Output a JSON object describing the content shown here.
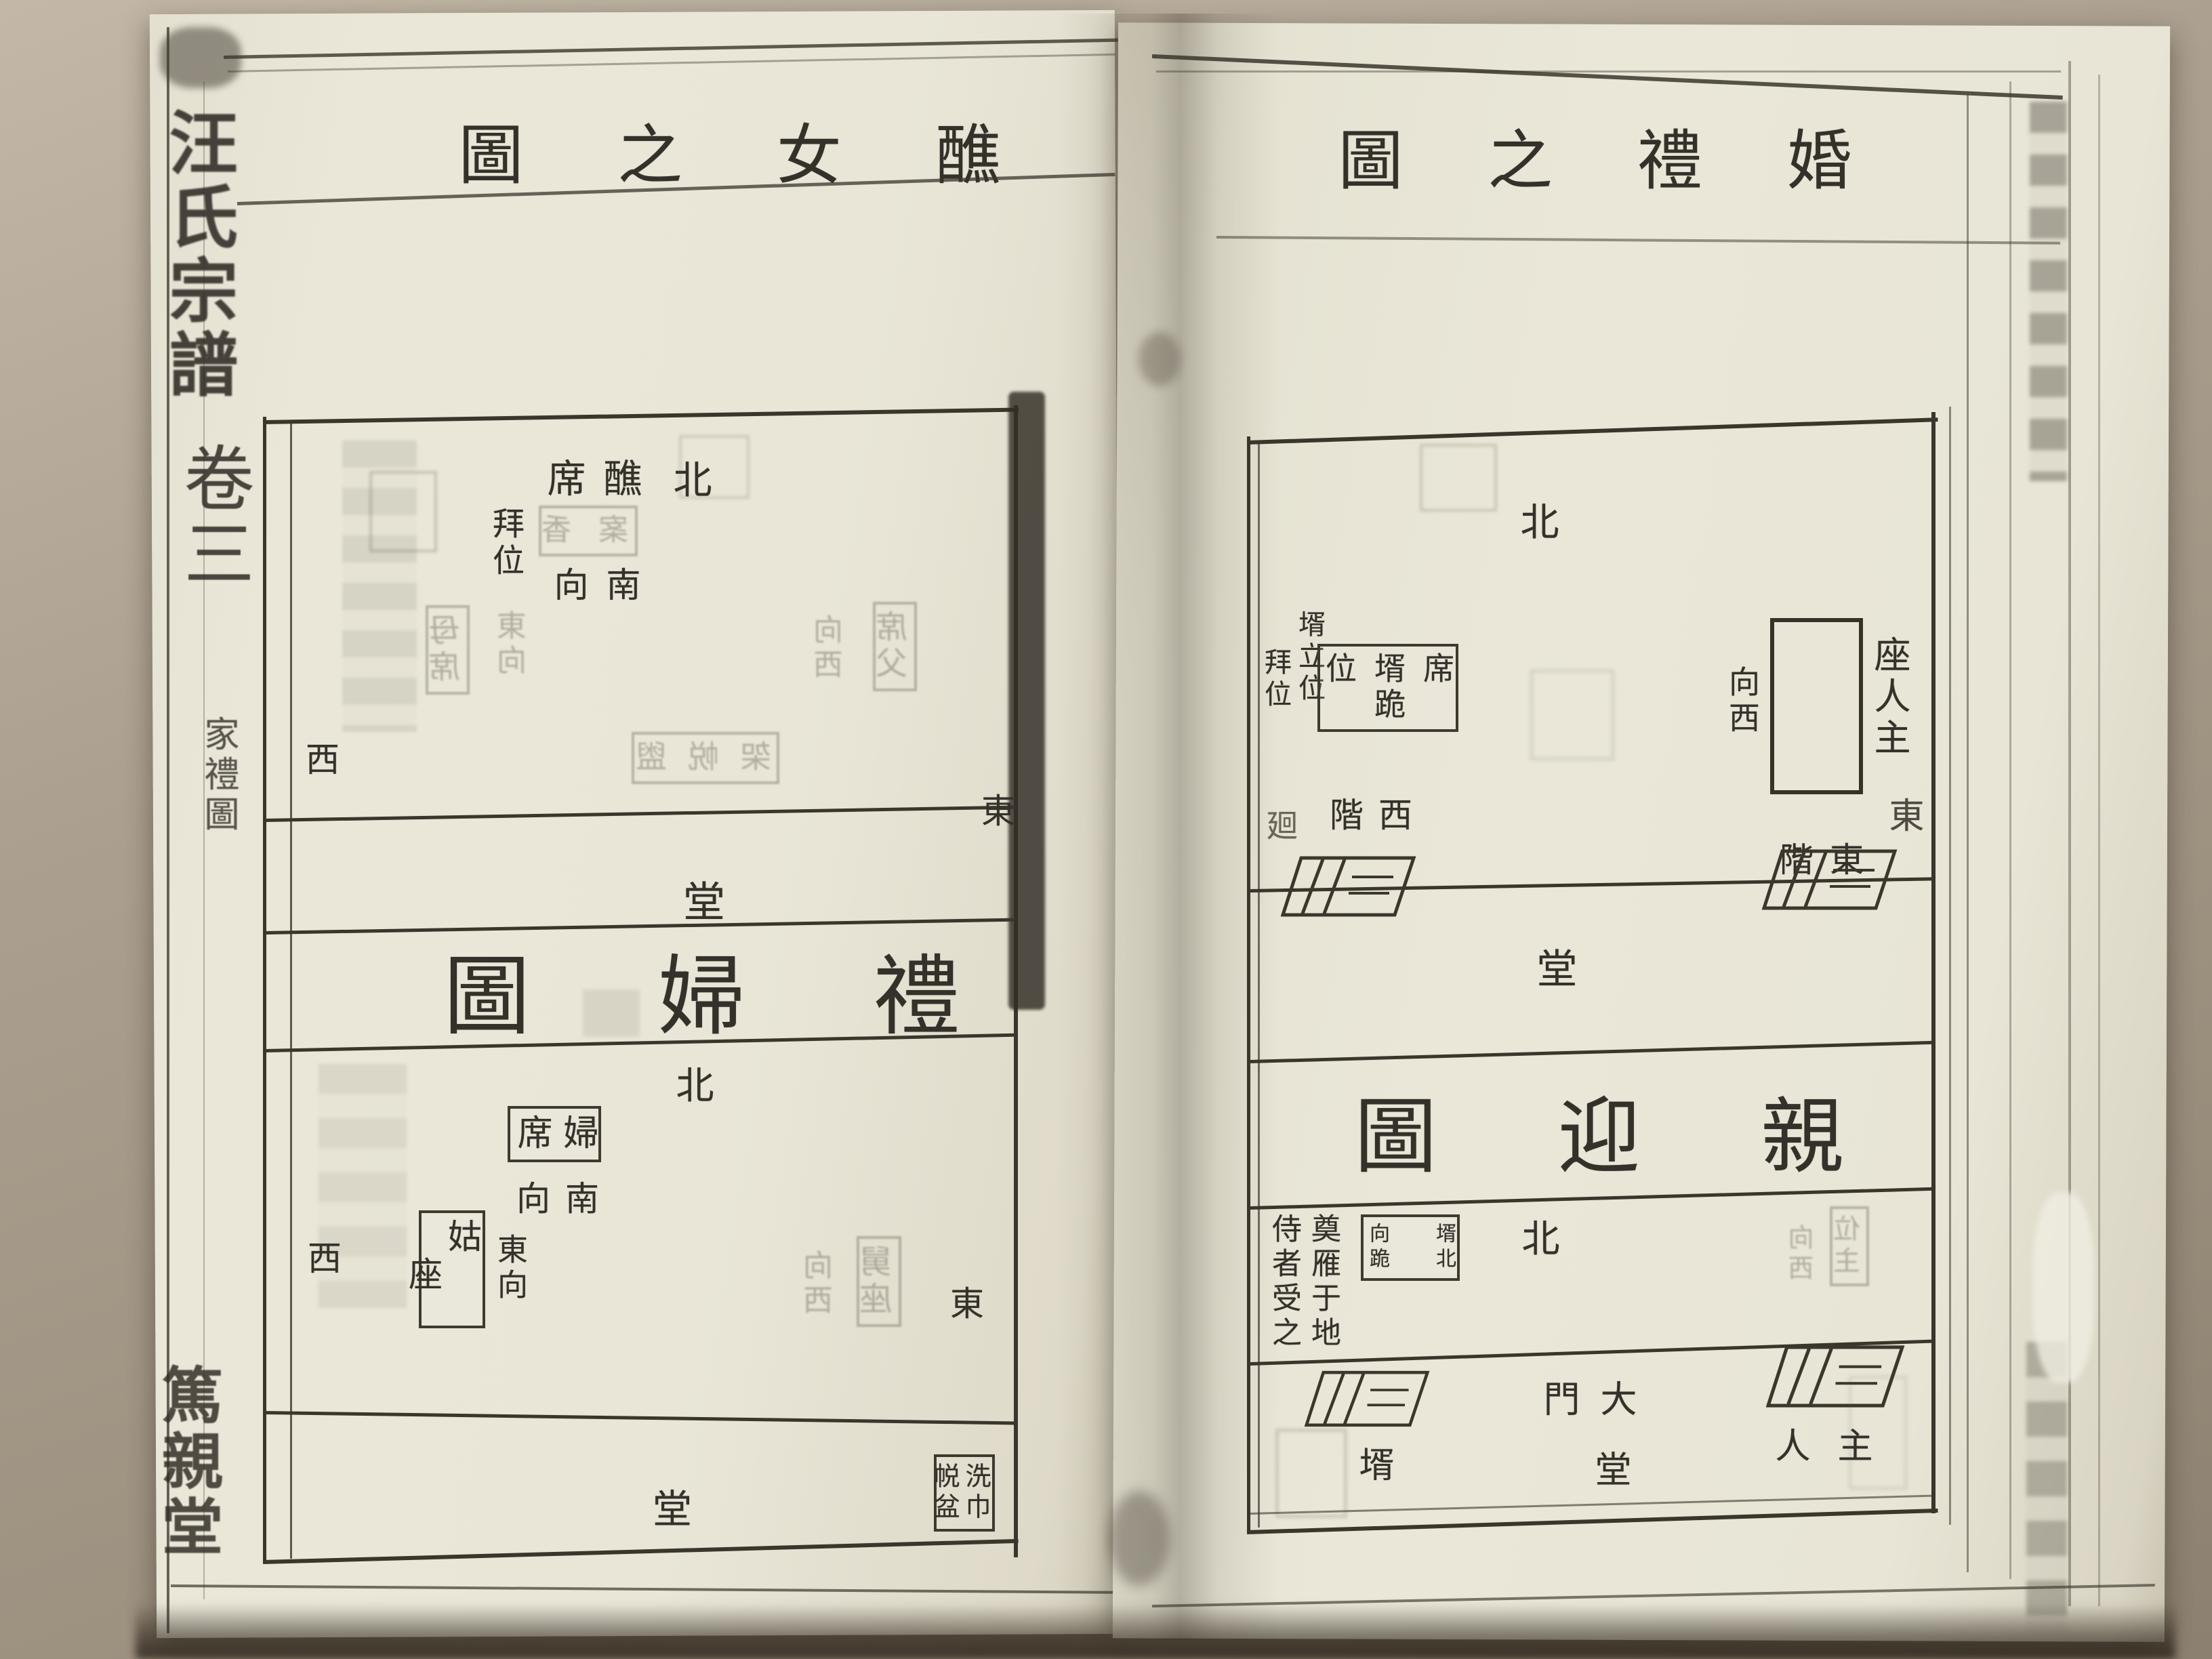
{
  "photo": {
    "paper_color": "#e9e6d8",
    "table_color": "#ab9f8f",
    "ink_color": "#34302a",
    "shadow_color": "#3f382e"
  },
  "left_page": {
    "spine": {
      "book_title": {
        "cols": [
          "汪氏宗譜"
        ]
      },
      "volume": {
        "cols": [
          "卷三"
        ]
      },
      "section": {
        "cols": [
          "家禮圖"
        ]
      },
      "hall_name": {
        "cols": [
          "篤親堂"
        ]
      }
    },
    "title": {
      "cols": [
        "醮",
        "女",
        "之",
        "圖"
      ]
    },
    "diagram_jiao_nv": {
      "north": {
        "cols": [
          "北"
        ]
      },
      "jiao_seat": {
        "cols": [
          "醮",
          "席"
        ]
      },
      "faces_south": {
        "cols": [
          "南",
          "向"
        ]
      },
      "bow_position": {
        "cols": [
          "拜位"
        ]
      },
      "ghost_table": {
        "cols": [
          "香",
          "案"
        ],
        "boxed": true,
        "ghost": true
      },
      "mother_seat": {
        "cols": [
          "母席"
        ],
        "boxed": true,
        "ghost": true
      },
      "mother_faces_east": {
        "cols": [
          "東向"
        ],
        "ghost": true
      },
      "father_seat": {
        "cols": [
          "席父"
        ],
        "boxed": true,
        "ghost": true
      },
      "father_faces_west": {
        "cols": [
          "向西"
        ],
        "ghost": true
      },
      "ghost_stand": {
        "cols": [
          "盥",
          "帨",
          "架"
        ],
        "boxed": true,
        "ghost": true
      },
      "west": {
        "cols": [
          "西"
        ]
      },
      "east": {
        "cols": [
          "東"
        ]
      }
    },
    "hall_upper": {
      "cols": [
        "堂"
      ]
    },
    "band_title": {
      "cols": [
        "禮",
        "婦",
        "圖"
      ]
    },
    "diagram_li_fu": {
      "north": {
        "cols": [
          "北"
        ]
      },
      "bride_seat": {
        "cols": [
          "婦",
          "席"
        ],
        "boxed": true
      },
      "faces_south": {
        "cols": [
          "南",
          "向"
        ]
      },
      "gu_seat": {
        "cols": [
          "姑",
          "座"
        ],
        "boxed": true
      },
      "gu_faces_east": {
        "cols": [
          "東向"
        ]
      },
      "jiu_seat": {
        "cols": [
          "舅座"
        ],
        "boxed": true,
        "ghost": true
      },
      "jiu_faces_west": {
        "cols": [
          "向西"
        ],
        "ghost": true
      },
      "west": {
        "cols": [
          "西"
        ]
      },
      "east": {
        "cols": [
          "東"
        ]
      },
      "hall": {
        "cols": [
          "堂"
        ]
      },
      "wash_basin": {
        "cols": [
          "洗巾",
          "帨盆"
        ],
        "boxed": true
      }
    }
  },
  "right_page": {
    "title": {
      "cols": [
        "婚",
        "禮",
        "之",
        "圖"
      ]
    },
    "diagram_qin_ying_hall": {
      "north": {
        "cols": [
          "北"
        ]
      },
      "groom_stand_bow": {
        "cols": [
          "壻立位",
          "拜位"
        ]
      },
      "groom_kneel_seat": {
        "cols": [
          "席",
          "壻跪",
          "位"
        ],
        "boxed": true
      },
      "turn_mark": {
        "cols": [
          "廻"
        ]
      },
      "west_steps": {
        "cols": [
          "西",
          "階"
        ]
      },
      "host_seat_facing": {
        "cols": [
          "向西"
        ]
      },
      "host_seat": {
        "cols": [
          "座人主"
        ]
      },
      "east": {
        "cols": [
          "東"
        ]
      },
      "east_steps": {
        "cols": [
          "東",
          "階"
        ]
      },
      "hall": {
        "cols": [
          "堂"
        ]
      }
    },
    "band_title": {
      "cols": [
        "親",
        "迎",
        "圖"
      ]
    },
    "diagram_qin_ying_gate": {
      "north": {
        "cols": [
          "北"
        ]
      },
      "groom_kneels_north": {
        "cols": [
          "壻北",
          "向跪"
        ],
        "boxed": true
      },
      "goose_rite": {
        "cols": [
          "奠雁于地",
          "侍者受之"
        ]
      },
      "groom": {
        "cols": [
          "壻"
        ]
      },
      "main_gate": {
        "cols": [
          "大",
          "門"
        ]
      },
      "hall": {
        "cols": [
          "堂"
        ]
      },
      "host": {
        "cols": [
          "主",
          "人"
        ]
      },
      "ghost_position": {
        "cols": [
          "位主"
        ],
        "boxed": true,
        "ghost": true
      },
      "ghost_faces_west": {
        "cols": [
          "向西"
        ],
        "ghost": true
      }
    }
  }
}
